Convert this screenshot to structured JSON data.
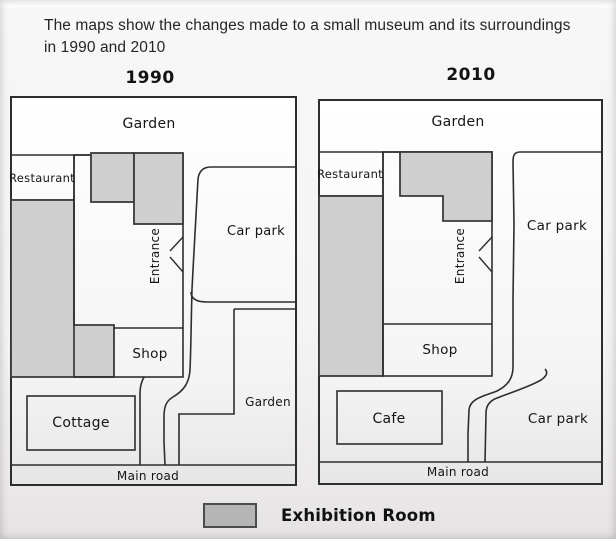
{
  "title": "The maps show the changes made to a small museum and its surroundings in 1990 and 2010",
  "maps": [
    {
      "year": "1990",
      "labels": {
        "garden_top": "Garden",
        "restaurant": "Restaurant",
        "car_park": "Car park",
        "entrance": "Entrance",
        "shop": "Shop",
        "cottage": "Cottage",
        "garden_bottom": "Garden",
        "main_road": "Main road"
      }
    },
    {
      "year": "2010",
      "labels": {
        "garden_top": "Garden",
        "restaurant": "Restaurant",
        "car_park_top": "Car park",
        "entrance": "Entrance",
        "shop": "Shop",
        "cafe": "Cafe",
        "car_park_bottom": "Car park",
        "main_road": "Main road"
      }
    }
  ],
  "legend": {
    "label": "Exhibition Room",
    "swatch_color": "#b5b5b5"
  },
  "colors": {
    "exhibition_fill": "#cfcfcf",
    "line": "#2e2e2e",
    "text": "#151515"
  }
}
